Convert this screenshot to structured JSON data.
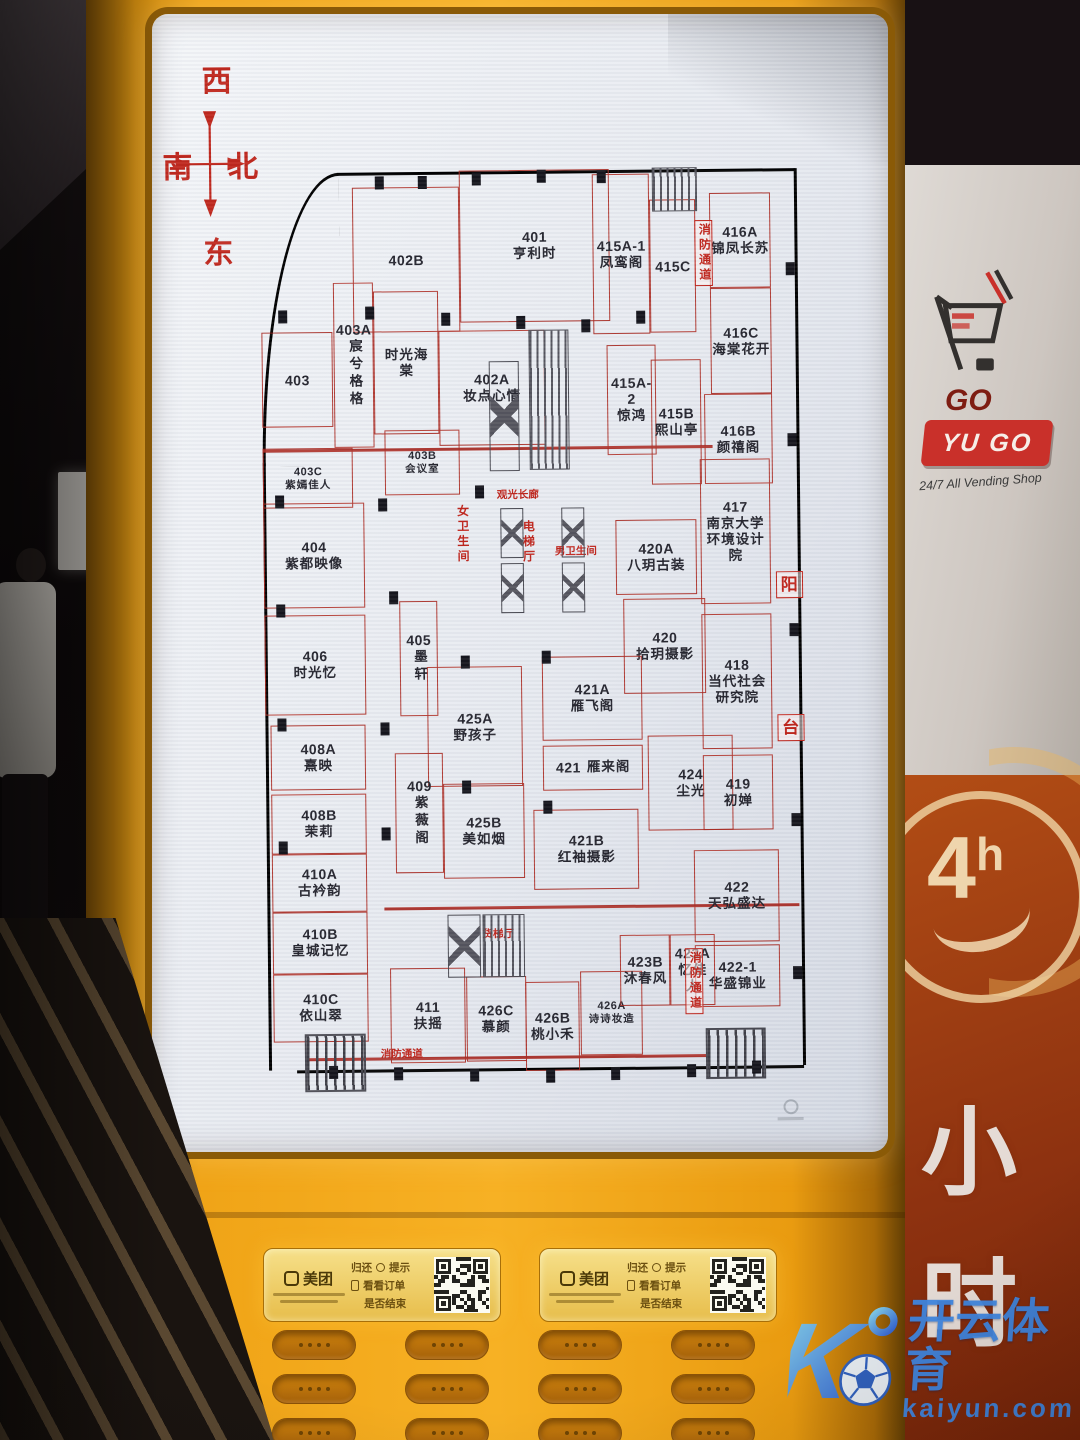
{
  "colors": {
    "kiosk_orange": "#f0a417",
    "plan_red": "#ad2d24",
    "red_text": "#c0251c",
    "watermark_blue": "#3f86e0",
    "panel_red": "#8e3210",
    "logo_red": "#c9302a",
    "meituan_yellow": "#f6e08a"
  },
  "compass": {
    "top": "西",
    "left": "南",
    "right": "北",
    "bottom": "东"
  },
  "floorplan": {
    "rooms": [
      {
        "unit": "402B",
        "name": "",
        "x": 17.9,
        "y": 3.7,
        "w": 19.7,
        "h": 15.3
      },
      {
        "unit": "401",
        "name": "亨利时",
        "x": 37.6,
        "y": 2.0,
        "w": 27.7,
        "h": 16.0
      },
      {
        "unit": "415A-1",
        "name": "凤鸾阁",
        "x": 62.2,
        "y": 2.6,
        "w": 10.5,
        "h": 16.8
      },
      {
        "unit": "415C",
        "name": "",
        "x": 72.7,
        "y": 5.3,
        "w": 8.5,
        "h": 14.0
      },
      {
        "unit": "416A",
        "name": "锦凤长苏",
        "x": 83.8,
        "y": 4.7,
        "w": 11.2,
        "h": 10.0
      },
      {
        "unit": "403A",
        "name": "宸兮格格",
        "vert": true,
        "x": 14.2,
        "y": 13.7,
        "w": 7.4,
        "h": 17.4
      },
      {
        "unit": "403",
        "name": "",
        "x": 0.9,
        "y": 18.9,
        "w": 13.0,
        "h": 10.0
      },
      {
        "unit": "",
        "name": "时光海棠",
        "wrap": 3.4,
        "x": 21.6,
        "y": 14.7,
        "w": 12.0,
        "h": 15.0
      },
      {
        "unit": "402A",
        "name": "妆点心情",
        "x": 33.6,
        "y": 18.9,
        "w": 19.4,
        "h": 12.1
      },
      {
        "unit": "415A-2",
        "name": "惊鸿",
        "x": 64.6,
        "y": 20.5,
        "w": 8.9,
        "h": 11.6
      },
      {
        "unit": "415B",
        "name": "熙山亭",
        "x": 72.7,
        "y": 22.1,
        "w": 9.2,
        "h": 13.2
      },
      {
        "unit": "416C",
        "name": "海棠花开",
        "x": 83.8,
        "y": 14.7,
        "w": 11.2,
        "h": 11.1
      },
      {
        "unit": "416B",
        "name": "颜禧阁",
        "x": 82.5,
        "y": 25.8,
        "w": 12.4,
        "h": 9.5
      },
      {
        "unit": "403C",
        "name": "紫嫣佳人",
        "small": true,
        "x": 0.9,
        "y": 31.1,
        "w": 16.6,
        "h": 6.3
      },
      {
        "unit": "403B",
        "name": "会议室",
        "small": true,
        "x": 23.4,
        "y": 29.3,
        "w": 13.8,
        "h": 6.8
      },
      {
        "unit": "404",
        "name": "紫都映像",
        "x": 0.9,
        "y": 36.8,
        "w": 18.5,
        "h": 11.1
      },
      {
        "unit": "417",
        "name": "南京大学环境设计院",
        "wrap": 5.2,
        "x": 81.5,
        "y": 32.6,
        "w": 13.0,
        "h": 15.3
      },
      {
        "unit": "420A",
        "name": "八玥古装",
        "x": 65.9,
        "y": 38.9,
        "w": 14.8,
        "h": 7.9
      },
      {
        "unit": "406",
        "name": "时光忆",
        "x": 0.9,
        "y": 48.6,
        "w": 18.5,
        "h": 10.5
      },
      {
        "unit": "405",
        "name": "墨轩",
        "vert": true,
        "x": 25.8,
        "y": 47.2,
        "w": 7.0,
        "h": 12.1
      },
      {
        "unit": "420",
        "name": "拾玥摄影",
        "x": 67.2,
        "y": 47.2,
        "w": 15.1,
        "h": 10.0
      },
      {
        "unit": "418",
        "name": "当代社会研究院",
        "wrap": 4.6,
        "x": 81.5,
        "y": 48.9,
        "w": 13.0,
        "h": 14.2
      },
      {
        "unit": "425A",
        "name": "野孩子",
        "x": 30.8,
        "y": 54.2,
        "w": 17.5,
        "h": 12.6
      },
      {
        "unit": "421A",
        "name": "雁飞阁",
        "x": 52.0,
        "y": 53.2,
        "w": 18.5,
        "h": 8.9
      },
      {
        "unit": "421",
        "name": "雁来阁",
        "row": true,
        "x": 52.0,
        "y": 62.6,
        "w": 18.5,
        "h": 4.7
      },
      {
        "unit": "424",
        "name": "尘光",
        "x": 71.4,
        "y": 61.6,
        "w": 15.7,
        "h": 10.0
      },
      {
        "unit": "419",
        "name": "初婵",
        "x": 81.5,
        "y": 63.7,
        "w": 13.0,
        "h": 7.9
      },
      {
        "unit": "408A",
        "name": "熹映",
        "x": 1.8,
        "y": 60.2,
        "w": 17.5,
        "h": 6.8
      },
      {
        "unit": "408B",
        "name": "茉莉",
        "x": 1.8,
        "y": 67.4,
        "w": 17.5,
        "h": 6.3
      },
      {
        "unit": "409",
        "name": "紫薇阁",
        "vert": true,
        "x": 24.7,
        "y": 63.2,
        "w": 8.9,
        "h": 12.6
      },
      {
        "unit": "425B",
        "name": "美如烟",
        "x": 33.6,
        "y": 66.5,
        "w": 14.8,
        "h": 10.0
      },
      {
        "unit": "421B",
        "name": "红袖摄影",
        "x": 50.2,
        "y": 69.3,
        "w": 19.4,
        "h": 8.4
      },
      {
        "unit": "410A",
        "name": "古衿韵",
        "x": 1.8,
        "y": 73.7,
        "w": 17.5,
        "h": 6.1
      },
      {
        "unit": "410B",
        "name": "皇城记忆",
        "x": 1.8,
        "y": 79.8,
        "w": 17.5,
        "h": 6.5
      },
      {
        "unit": "410C",
        "name": "依山翠",
        "x": 1.8,
        "y": 86.3,
        "w": 17.5,
        "h": 7.2
      },
      {
        "unit": "422",
        "name": "天弘盛达",
        "x": 79.7,
        "y": 73.7,
        "w": 15.7,
        "h": 9.7
      },
      {
        "unit": "422-1",
        "name": "华盛锦业",
        "x": 79.7,
        "y": 83.7,
        "w": 15.7,
        "h": 6.5
      },
      {
        "unit": "411",
        "name": "扶摇",
        "x": 23.4,
        "y": 85.8,
        "w": 13.8,
        "h": 10.0
      },
      {
        "unit": "426C",
        "name": "慕颜",
        "x": 37.3,
        "y": 86.8,
        "w": 11.1,
        "h": 8.9
      },
      {
        "unit": "426B",
        "name": "桃小禾",
        "x": 48.3,
        "y": 87.4,
        "w": 10.0,
        "h": 9.3
      },
      {
        "unit": "426A",
        "name": "诗诗妆造",
        "small": true,
        "x": 58.5,
        "y": 86.3,
        "w": 11.4,
        "h": 8.9
      },
      {
        "unit": "423B",
        "name": "沐春风",
        "x": 65.9,
        "y": 82.6,
        "w": 9.2,
        "h": 7.4
      },
      {
        "unit": "423A",
        "name": "忆佳人",
        "x": 75.1,
        "y": 82.6,
        "w": 8.3,
        "h": 7.4
      }
    ],
    "facilities": [
      {
        "label": "观光长廊",
        "x": 44.0,
        "y": 35.6,
        "small": true
      },
      {
        "label": "女卫生间",
        "x": 36.2,
        "y": 37.2,
        "vert": true
      },
      {
        "label": "电梯厅",
        "x": 48.3,
        "y": 38.8,
        "vert": true
      },
      {
        "label": "男卫生间",
        "x": 54.6,
        "y": 41.6,
        "small": true
      },
      {
        "label": "货梯厅",
        "x": 40.5,
        "y": 81.7,
        "small": true
      },
      {
        "label": "消防通道",
        "x": 81.0,
        "y": 7.5,
        "vert": true,
        "boxed": true
      },
      {
        "label": "消防通道",
        "x": 77.9,
        "y": 84.0,
        "vert": true,
        "boxed": true
      },
      {
        "label": "消防通道",
        "x": 21.5,
        "y": 94.2,
        "small": true
      },
      {
        "label": "阳",
        "x": 95.3,
        "y": 44.5,
        "boxed": true,
        "big": true
      },
      {
        "label": "台",
        "x": 95.3,
        "y": 59.5,
        "boxed": true,
        "big": true
      }
    ],
    "features": [
      {
        "type": "hatch",
        "x": 73.2,
        "y": 1.9,
        "w": 8.3,
        "h": 4.7
      },
      {
        "type": "xshaft",
        "x": 42.8,
        "y": 22.1,
        "w": 5.5,
        "h": 11.6
      },
      {
        "type": "hatch",
        "x": 50.2,
        "y": 18.9,
        "w": 7.4,
        "h": 14.7
      },
      {
        "type": "xshaft",
        "x": 44.5,
        "y": 37.6,
        "w": 4.3,
        "h": 5.2
      },
      {
        "type": "xshaft",
        "x": 44.5,
        "y": 43.4,
        "w": 4.3,
        "h": 5.2
      },
      {
        "type": "xshaft",
        "x": 55.8,
        "y": 37.6,
        "w": 4.3,
        "h": 5.2
      },
      {
        "type": "xshaft",
        "x": 55.8,
        "y": 43.4,
        "w": 4.3,
        "h": 5.2
      },
      {
        "type": "xshaft",
        "x": 34.0,
        "y": 80.3,
        "w": 6.2,
        "h": 6.6
      },
      {
        "type": "hatch",
        "x": 40.6,
        "y": 80.3,
        "w": 7.6,
        "h": 6.6
      },
      {
        "type": "stairs",
        "x": 7.4,
        "y": 92.6,
        "w": 11.4,
        "h": 6.2
      },
      {
        "type": "stairs",
        "x": 81.5,
        "y": 92.4,
        "w": 11.1,
        "h": 5.4
      }
    ],
    "ticks": [
      [
        22,
        2.6
      ],
      [
        30,
        2.6
      ],
      [
        40,
        2.3
      ],
      [
        52,
        2.0
      ],
      [
        63,
        2.1
      ],
      [
        4,
        16.5
      ],
      [
        20,
        16.2
      ],
      [
        34,
        17.0
      ],
      [
        48,
        17.4
      ],
      [
        60,
        17.8
      ],
      [
        70,
        17.0
      ],
      [
        3,
        36.0
      ],
      [
        22,
        36.4
      ],
      [
        40,
        35.2
      ],
      [
        3,
        47.5
      ],
      [
        24,
        46.2
      ],
      [
        3,
        59.4
      ],
      [
        22,
        60.0
      ],
      [
        37,
        53.0
      ],
      [
        52,
        52.6
      ],
      [
        3,
        72.4
      ],
      [
        22,
        71.0
      ],
      [
        37,
        66.2
      ],
      [
        52,
        68.4
      ],
      [
        12,
        96.0
      ],
      [
        24,
        96.2
      ],
      [
        38,
        96.4
      ],
      [
        52,
        96.6
      ],
      [
        64,
        96.4
      ],
      [
        78,
        96.2
      ],
      [
        90,
        95.9
      ],
      [
        97.8,
        12
      ],
      [
        97.8,
        30
      ],
      [
        97.8,
        50
      ],
      [
        97.8,
        70
      ],
      [
        97.8,
        86
      ]
    ]
  },
  "qr_panels": [
    {
      "brand": "美团",
      "hints": [
        "归还",
        "提示",
        "看看订单",
        "是否结束"
      ]
    },
    {
      "brand": "美团",
      "hints": [
        "归还",
        "提示",
        "看看订单",
        "是否结束"
      ]
    }
  ],
  "dispenser": {
    "rows": 3,
    "cols": 4
  },
  "side_panel": {
    "go": "GO",
    "yugo": "YU GO",
    "tagline": "24/7 All Vending Shop",
    "badge_num": "4",
    "badge_unit": "h",
    "vertical_chars": [
      "小",
      "时"
    ]
  },
  "watermark": {
    "letter": "K",
    "brand": "开云体育",
    "domain": "kaiyun.com"
  }
}
